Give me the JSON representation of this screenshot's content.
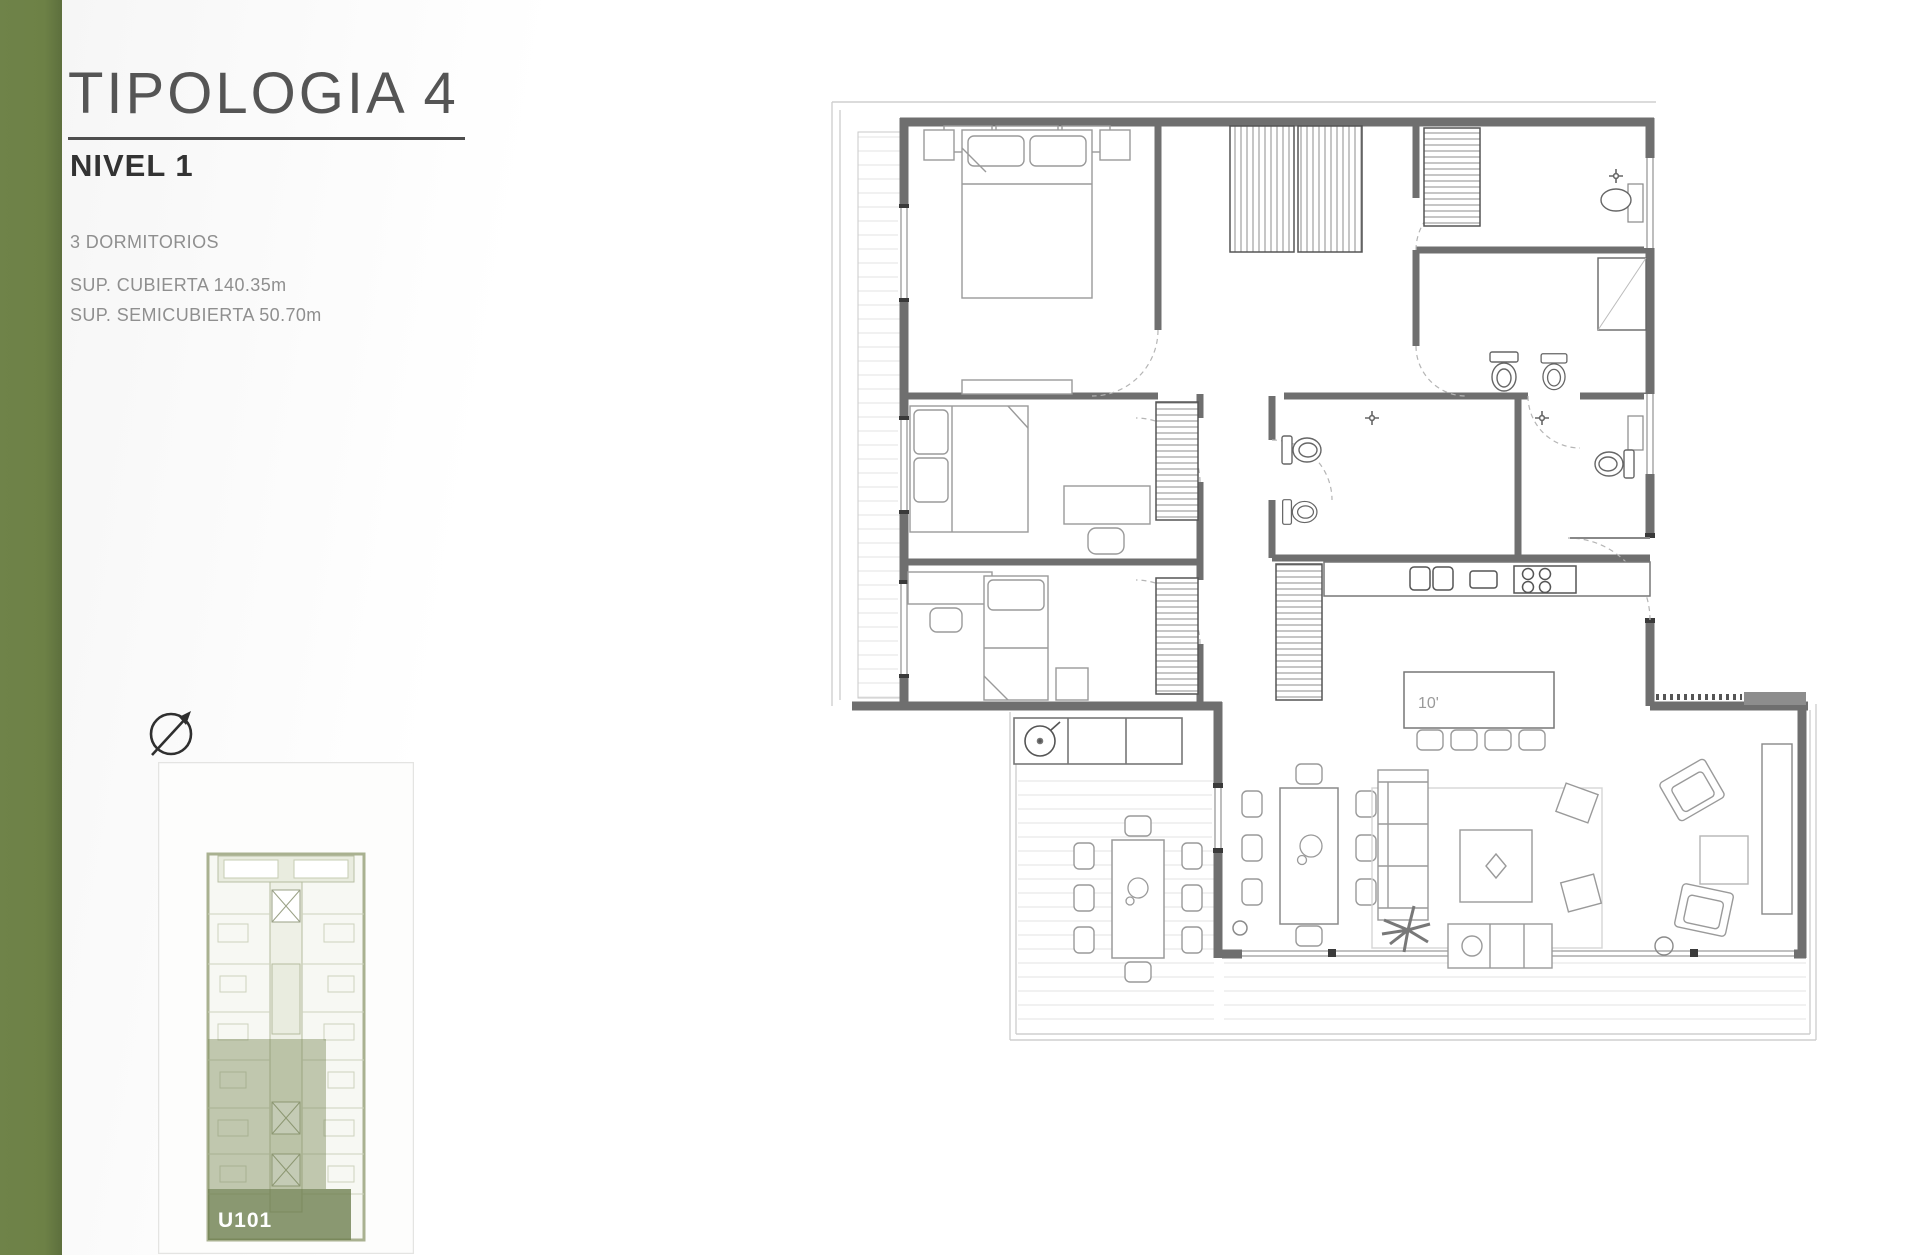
{
  "page": {
    "accent_bar_color": "#6d8146",
    "background_color": "#ffffff"
  },
  "header": {
    "title": "TIPOLOGIA 4",
    "subtitle": "NIVEL 1"
  },
  "details": {
    "bedrooms": "3 DORMITORIOS",
    "covered_area": "SUP. CUBIERTA 140.35m",
    "semi_covered_area": "SUP. SEMICUBIERTA 50.70m"
  },
  "key_plan": {
    "unit_label": "U101",
    "highlight_color": "#7c8b59"
  },
  "floor_plan": {
    "island_label": "10'"
  }
}
